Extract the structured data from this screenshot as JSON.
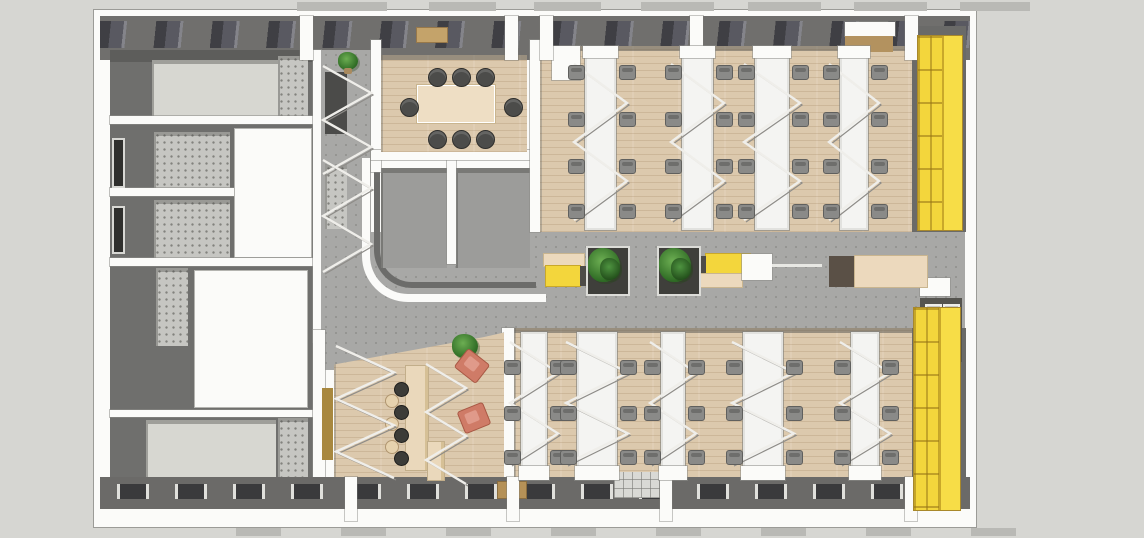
{
  "scene_label": "office-floor-plan-3d-top-view",
  "palette": {
    "bg": "#d6d6d2",
    "white": "#fbfbf9",
    "wall-dark": "#6f6f6d",
    "facade": "#706f6d",
    "glazing": "#3f3f44",
    "corridor": "#a8a8a6",
    "concrete": "#c6c6c2",
    "room-gray": "#9c9c9a",
    "light-floor": "#d7d7d1",
    "wood": "#dcc9ad",
    "desk-white": "#f4f4f2",
    "chair": "#8a8a88",
    "chair-dark": "#4c4c4a",
    "table": "#eedec4",
    "yellow": "#f3d63c",
    "yellow-bright": "#f7dd47",
    "bench-beige": "#ecd9bd",
    "bench-cap": "#4e4c48",
    "coral": "#cf7b67",
    "green": "#3f7d33",
    "stool-dark": "#3c3c38",
    "stool-beige": "#e6d2ae",
    "tan": "#b3925f",
    "booth": "#55544f",
    "glass": "#c7c7c3",
    "tab": "#b9b9b5"
  },
  "zones": {
    "service_core": "stair-elevator-core-west",
    "meeting_room": {
      "seats": 8
    },
    "open_office_north": {
      "desk_rows": 4,
      "chairs_per_row": 8
    },
    "open_office_south": {
      "desk_rows": 5,
      "chairs_per_row": 6
    },
    "central_corridor": {
      "benches": 2,
      "planters": 2
    },
    "cafe_lounge": {
      "bar_stools": 7,
      "lounge_chairs": 2
    },
    "locker_walls": 2,
    "stairwells": 2
  },
  "furniture": {
    "desk_rows_top": {
      "y": 44,
      "h": 176,
      "chair_rows": [
        62,
        109,
        156,
        201
      ],
      "rows": [
        {
          "x": 491,
          "w": 31
        },
        {
          "x": 588,
          "w": 31
        },
        {
          "x": 661,
          "w": 34
        },
        {
          "x": 746,
          "w": 28
        }
      ]
    },
    "desk_rows_bottom": {
      "y": 322,
      "h": 142,
      "chair_rows": [
        357,
        403,
        447
      ],
      "rows": [
        {
          "x": 427,
          "w": 26
        },
        {
          "x": 483,
          "w": 40
        },
        {
          "x": 567,
          "w": 24
        },
        {
          "x": 649,
          "w": 40
        },
        {
          "x": 757,
          "w": 28
        }
      ]
    },
    "meeting_table": {
      "x": 324,
      "y": 76,
      "w": 76,
      "h": 36
    },
    "meeting_chairs": [
      [
        334,
        58
      ],
      [
        358,
        58
      ],
      [
        382,
        58
      ],
      [
        334,
        120
      ],
      [
        358,
        120
      ],
      [
        382,
        120
      ],
      [
        306,
        88
      ],
      [
        410,
        88
      ]
    ],
    "corridor_benches": [
      {
        "style": "yellow-left",
        "x": 450,
        "y": 242
      },
      {
        "style": "yellow-right",
        "x": 602,
        "y": 242
      },
      {
        "style": "white-desk",
        "x": 648,
        "y": 244
      },
      {
        "style": "beige-table",
        "x": 735,
        "y": 246
      }
    ],
    "planters": [
      [
        492,
        236
      ],
      [
        563,
        236
      ]
    ],
    "plants": [
      [
        244,
        42,
        20
      ],
      [
        358,
        324,
        26
      ]
    ],
    "bar_counter": {
      "x": 312,
      "y": 356,
      "w": 22,
      "h": 104,
      "foot": {
        "x": 334,
        "y": 432,
        "w": 16,
        "h": 38
      }
    },
    "stools_dark": [
      [
        300,
        372
      ],
      [
        300,
        395
      ],
      [
        300,
        418
      ],
      [
        300,
        441
      ]
    ],
    "stools_beige": [
      [
        291,
        384
      ],
      [
        291,
        407
      ],
      [
        291,
        430
      ]
    ],
    "lounge_chairs": [
      {
        "x": 364,
        "y": 344,
        "rot": 38
      },
      {
        "x": 366,
        "y": 396,
        "rot": -22
      }
    ],
    "lockers": [
      {
        "x": 824,
        "y": 26,
        "w": 44,
        "h": 194
      },
      {
        "x": 820,
        "y": 298,
        "w": 46,
        "h": 202
      }
    ]
  },
  "structure": {
    "piers_top": [
      206,
      411,
      446,
      596,
      811
    ],
    "piers_bottom": [
      251,
      413,
      566,
      811
    ],
    "tabs_top": [
      [
        203,
        90
      ],
      [
        335,
        67
      ],
      [
        440,
        67
      ],
      [
        547,
        73
      ],
      [
        654,
        73
      ],
      [
        760,
        73
      ],
      [
        866,
        70
      ]
    ],
    "tabs_bottom": [
      [
        142,
        45
      ],
      [
        247,
        45
      ],
      [
        352,
        45
      ],
      [
        457,
        45
      ],
      [
        562,
        45
      ],
      [
        667,
        45
      ],
      [
        772,
        45
      ],
      [
        877,
        45
      ]
    ],
    "railings": [
      {
        "x": 227,
        "y": 54,
        "w": 52,
        "h": 112,
        "n": 4
      },
      {
        "x": 227,
        "y": 148,
        "w": 52,
        "h": 116,
        "n": 4
      },
      {
        "x": 240,
        "y": 334,
        "w": 62,
        "h": 136,
        "n": 5
      },
      {
        "x": 330,
        "y": 352,
        "w": 44,
        "h": 124,
        "n": 5
      }
    ]
  }
}
